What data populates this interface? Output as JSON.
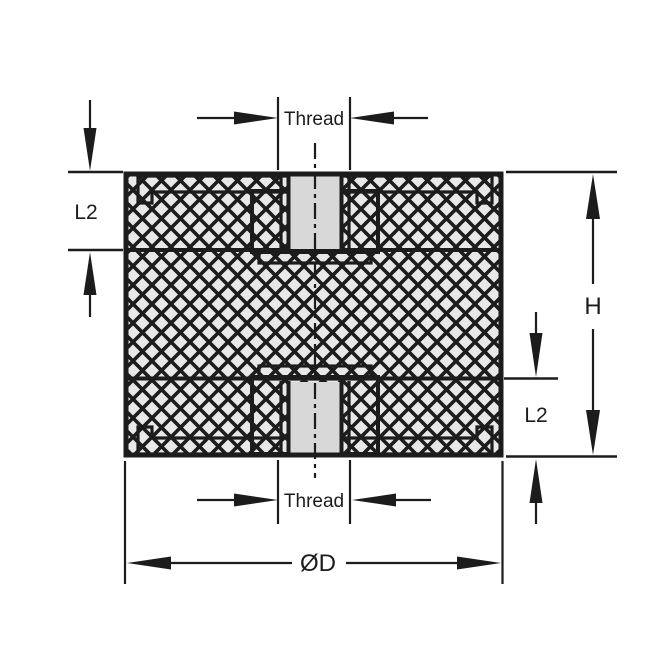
{
  "diagram": {
    "labels": {
      "thread_top": "Thread",
      "thread_bottom": "Thread",
      "l2_top_left": "L2",
      "l2_bottom_right": "L2",
      "height": "H",
      "diameter": "ØD"
    },
    "colors": {
      "line": "#1c1c1c",
      "rubber_fill": "#e8e8e8",
      "metal_fill": "#d8d8d8",
      "background": "#ffffff"
    }
  }
}
